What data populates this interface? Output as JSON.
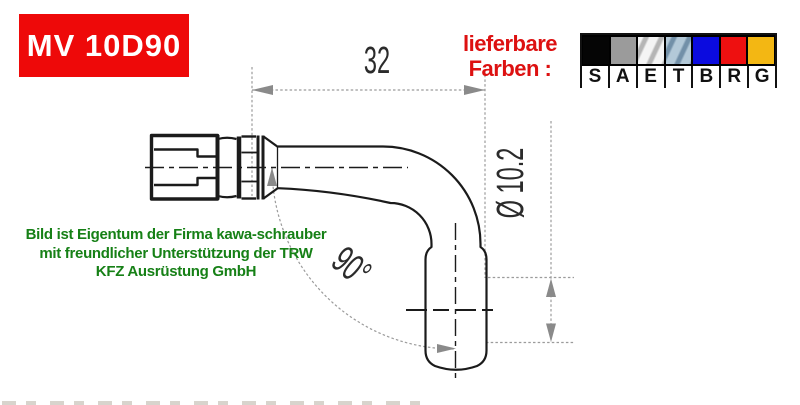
{
  "part_badge": {
    "text": "MV 10D90",
    "bg_color": "#ee0909",
    "text_color": "#ffffff"
  },
  "colors_label": {
    "line1": "lieferbare",
    "line2": "Farben :",
    "color": "#dd1111"
  },
  "color_table": {
    "swatches": [
      {
        "letter": "S",
        "color": "#050505",
        "metallic": false
      },
      {
        "letter": "A",
        "color": "#9b9b9b",
        "metallic": false
      },
      {
        "letter": "E",
        "color": "#d8d8d8",
        "metallic": true,
        "streak_light": "#f4f4f4",
        "streak_dark": "#b5b5b5"
      },
      {
        "letter": "T",
        "color": "#8fa9bd",
        "metallic": true,
        "streak_light": "#b3c9d8",
        "streak_dark": "#7290a8"
      },
      {
        "letter": "B",
        "color": "#0b0bdf",
        "metallic": false
      },
      {
        "letter": "R",
        "color": "#ee1010",
        "metallic": false
      },
      {
        "letter": "G",
        "color": "#f3b713",
        "metallic": false
      }
    ]
  },
  "drawing": {
    "dim_length": "32",
    "dim_diameter": "Ø 10.2",
    "dim_angle": "90°",
    "line_color": "#1b1b1b",
    "dim_color": "#999999"
  },
  "watermark": {
    "line1": "Bild ist Eigentum der Firma kawa-schrauber",
    "line2": "mit freundlicher Unterstützung der TRW",
    "line3": "KFZ Ausrüstung GmbH",
    "color": "#168016"
  }
}
